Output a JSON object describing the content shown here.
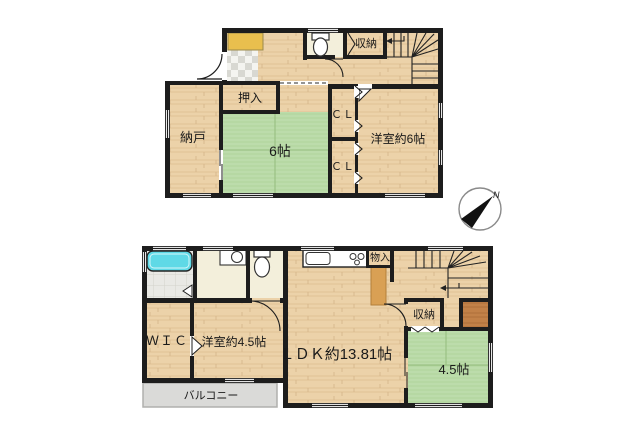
{
  "plan": {
    "upper": {
      "nando": "納戸",
      "oshiire": "押入",
      "tatami6": "6帖",
      "cl_top": "ＣＬ",
      "cl_bottom": "ＣＬ",
      "yoshitsu6": "洋室約6帖",
      "shuno": "収納"
    },
    "lower": {
      "monoire": "物入",
      "shuno": "収納",
      "wic": "ＷＩＣ",
      "yoshitsu45": "洋室約4.5帖",
      "ldk": "ＬＤＫ約13.81帖",
      "tatami45": "4.5帖",
      "balcony": "バルコニー"
    },
    "compass": {
      "north": "N"
    },
    "colors": {
      "wall": "#1d1d1d",
      "wood_floor": "#ecd2a9",
      "tatami_green": "#bcdcab",
      "bathtub_cyan": "#5fd9e6",
      "shoe_cabinet_yellow": "#e9bf4e",
      "dark_wood_closet": "#c28148",
      "balcony_gray": "#dadad8",
      "wet_room_cream": "#f3efdb"
    }
  }
}
